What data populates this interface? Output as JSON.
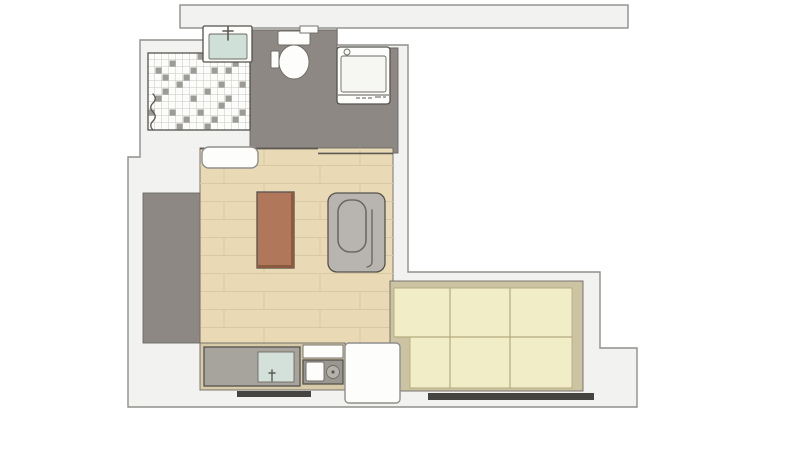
{
  "plan": {
    "type": "apartment-floor-plan",
    "rooms": [
      "bathroom",
      "shower",
      "hallway",
      "living-room",
      "kitchen",
      "sleeping-area"
    ],
    "fixtures": [
      "bathroom-vanity",
      "toilet",
      "washing-machine",
      "shower-tiles",
      "dining-table",
      "armchair",
      "kitchen-counter",
      "kitchen-sink",
      "stove-burner",
      "bed-platform",
      "windows"
    ]
  },
  "colors": {
    "page_bg": "#ffffff",
    "wall_fill": "#f2f2f0",
    "wall_stroke": "#8f8f8b",
    "gray_floor": "#8e8885",
    "tile_base": "#fcfcfb",
    "tile_accent": "#9c9b96",
    "tile_grid": "#c6c6c2",
    "wood_floor": "#e9dab5",
    "plank_line": "#d9c9a2",
    "table_top": "#b1775a",
    "table_edge": "#8c5a3e",
    "chair_fill": "#b8b4af",
    "chair_line": "#6d6a65",
    "bed_frame": "#ccc3a2",
    "bed_mattress": "#f1edc7",
    "bed_line": "#b5ab80",
    "kitchen_base": "#d6caa8",
    "counter_gray": "#a7a49e",
    "stove_panel": "#9a9791",
    "burner_gray": "#b5b2ac",
    "kitchen_sink_basin": "#d4e1da",
    "bath_sink_basin": "#cfe0d8",
    "fixture_white": "#fdfdfc",
    "drum_white": "#f6f6f3",
    "window_dark": "#454440",
    "edge_dark": "#5c5954"
  }
}
